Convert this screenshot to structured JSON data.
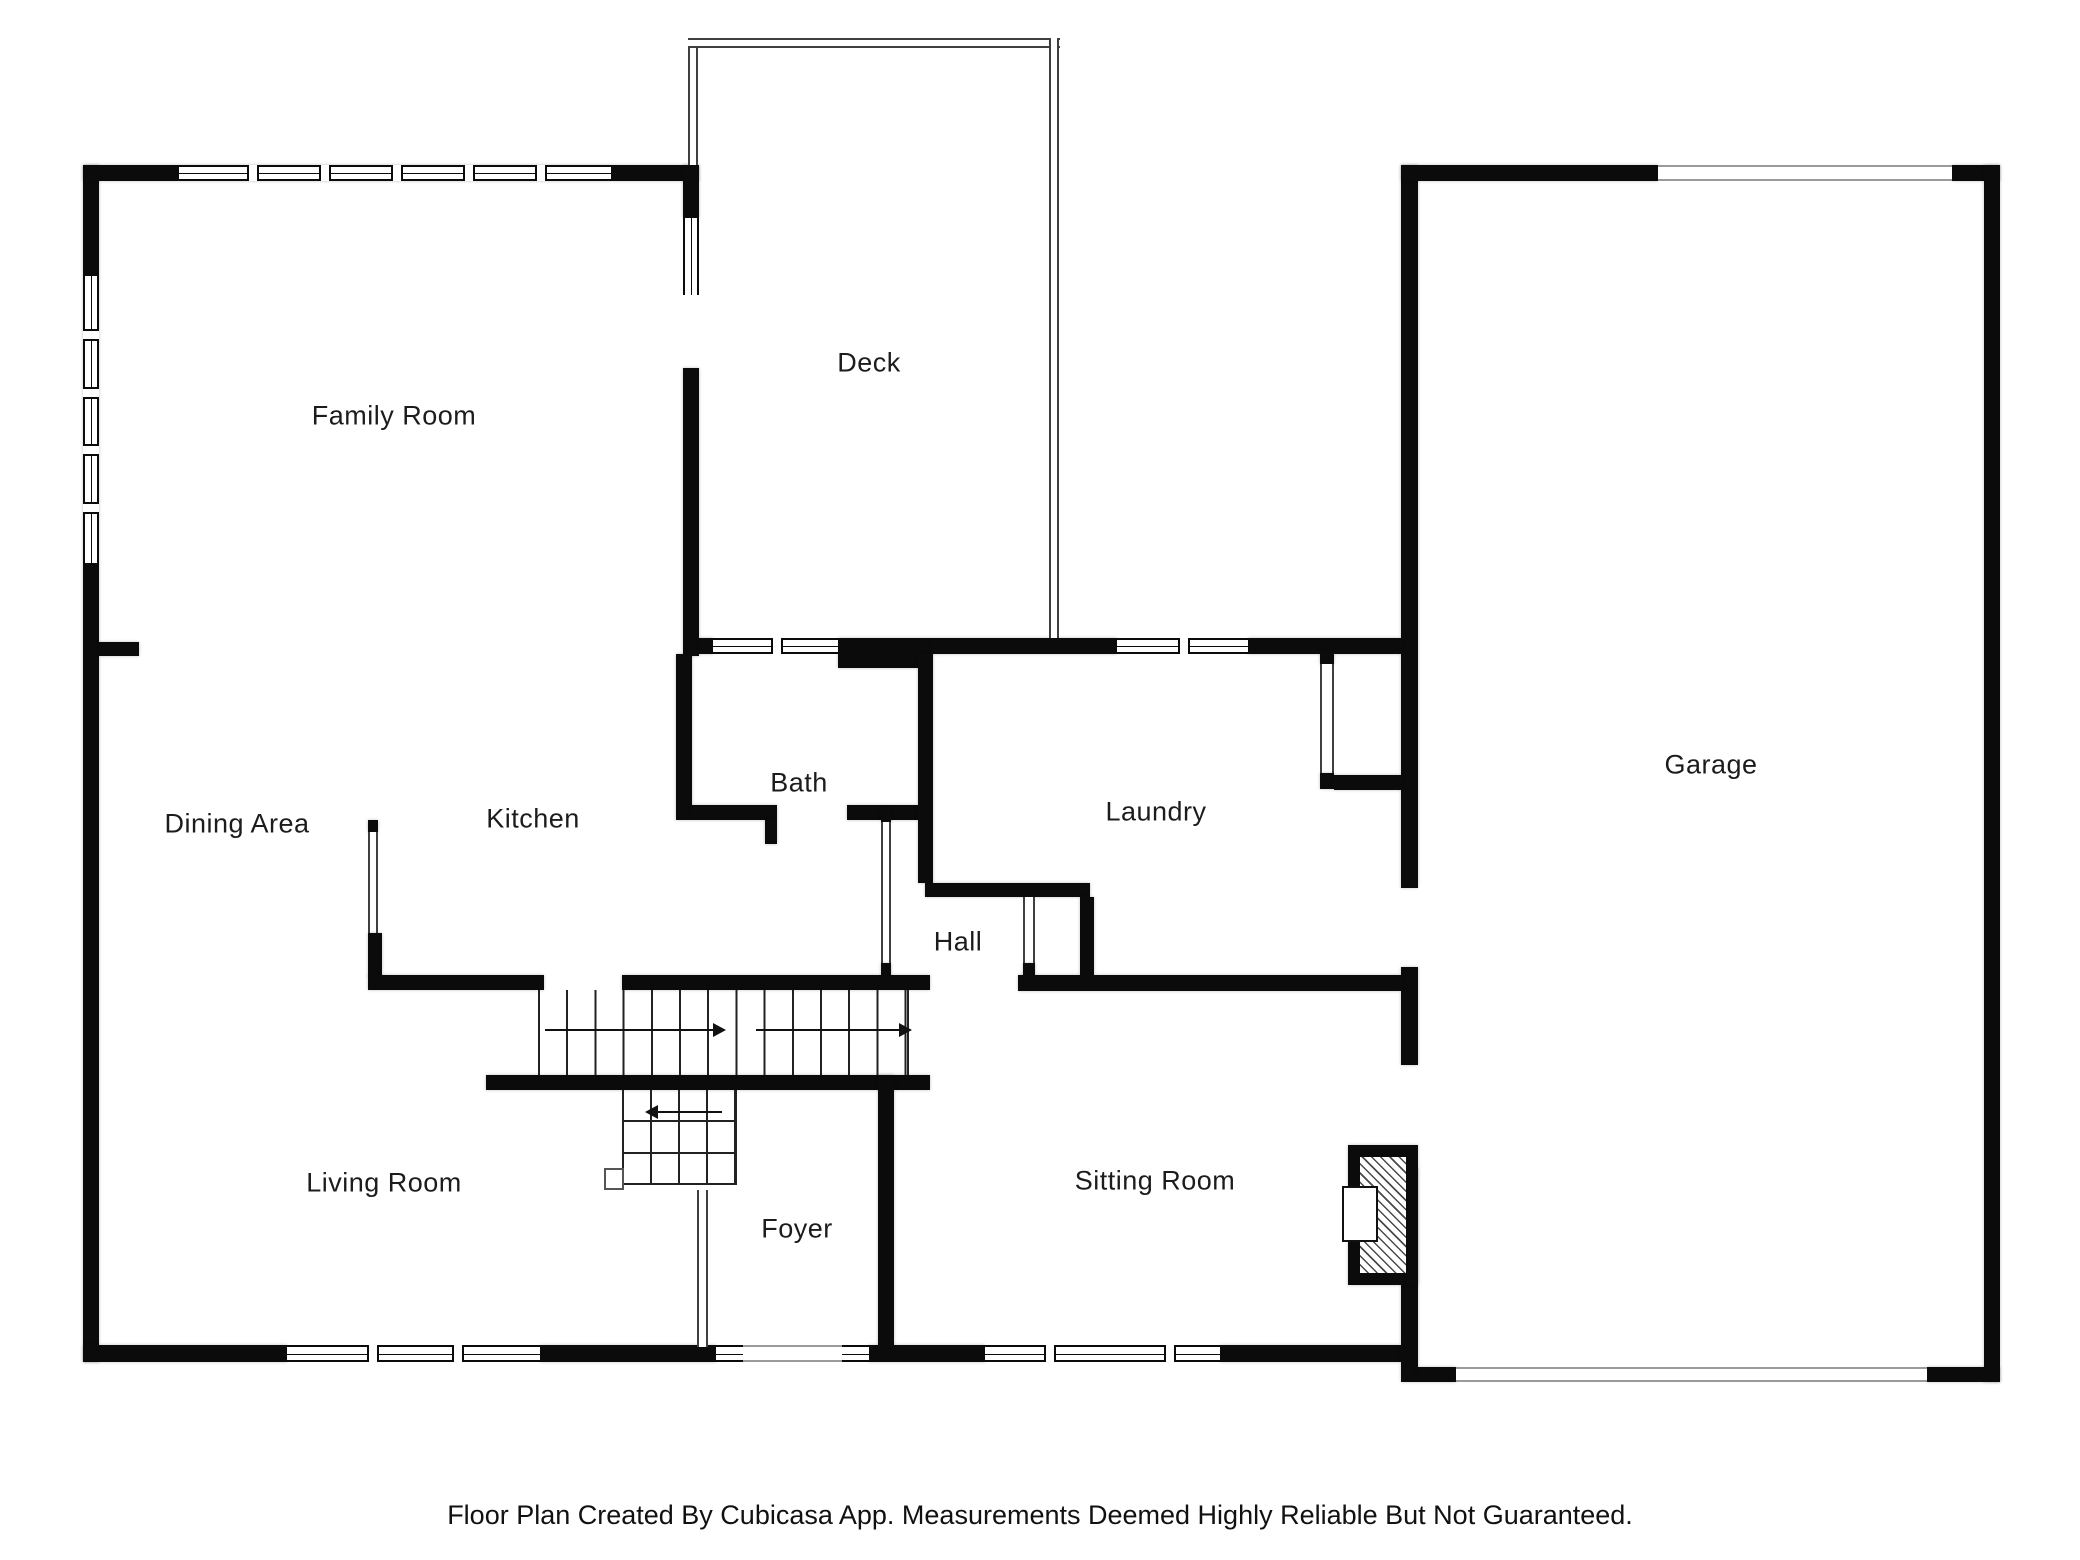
{
  "rooms": {
    "family_room": {
      "label": "Family Room"
    },
    "deck": {
      "label": "Deck"
    },
    "dining_area": {
      "label": "Dining Area"
    },
    "kitchen": {
      "label": "Kitchen"
    },
    "bath": {
      "label": "Bath"
    },
    "laundry": {
      "label": "Laundry"
    },
    "hall": {
      "label": "Hall"
    },
    "garage": {
      "label": "Garage"
    },
    "living_room": {
      "label": "Living Room"
    },
    "foyer": {
      "label": "Foyer"
    },
    "sitting_room": {
      "label": "Sitting Room"
    }
  },
  "footer": {
    "disclaimer": "Floor Plan Created By Cubicasa App. Measurements Deemed Highly Reliable But Not Guaranteed."
  },
  "colors": {
    "wall": "#0b0b0b",
    "thin_wall_line": "#3f3f3f",
    "door_opening_line": "#9a9a9a",
    "text": "#1c1c1c",
    "background": "#ffffff"
  },
  "symbols": {
    "stair_arrows": [
      "right",
      "right",
      "left"
    ],
    "fireplace": "hatched-masonry-fireplace"
  }
}
